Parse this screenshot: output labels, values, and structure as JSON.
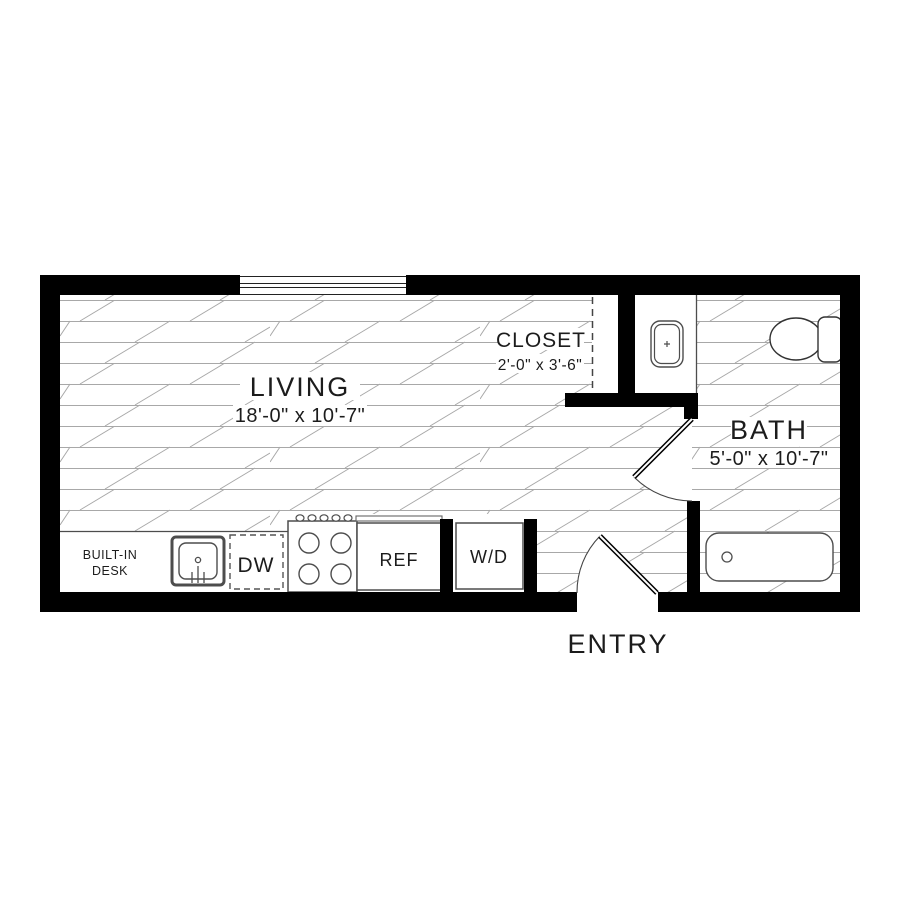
{
  "plan": {
    "title": "studio-floor-plan",
    "rooms": {
      "living": {
        "label": "LIVING",
        "dims": "18'-0\" x 10'-7\""
      },
      "closet": {
        "label": "CLOSET",
        "dims": "2'-0\" x 3'-6\""
      },
      "bath": {
        "label": "BATH",
        "dims": "5'-0\" x 10'-7\""
      },
      "entry": {
        "label": "ENTRY"
      }
    },
    "fixtures": {
      "desk_line1": "BUILT-IN",
      "desk_line2": "DESK",
      "dishwasher": "DW",
      "refrigerator": "REF",
      "washer_dryer": "W/D"
    },
    "colors": {
      "wall": "#000000",
      "plank_line": "#a8a8a8",
      "fixture_line": "#4d4d4d",
      "text": "#1c1c1c",
      "background": "#ffffff"
    }
  }
}
